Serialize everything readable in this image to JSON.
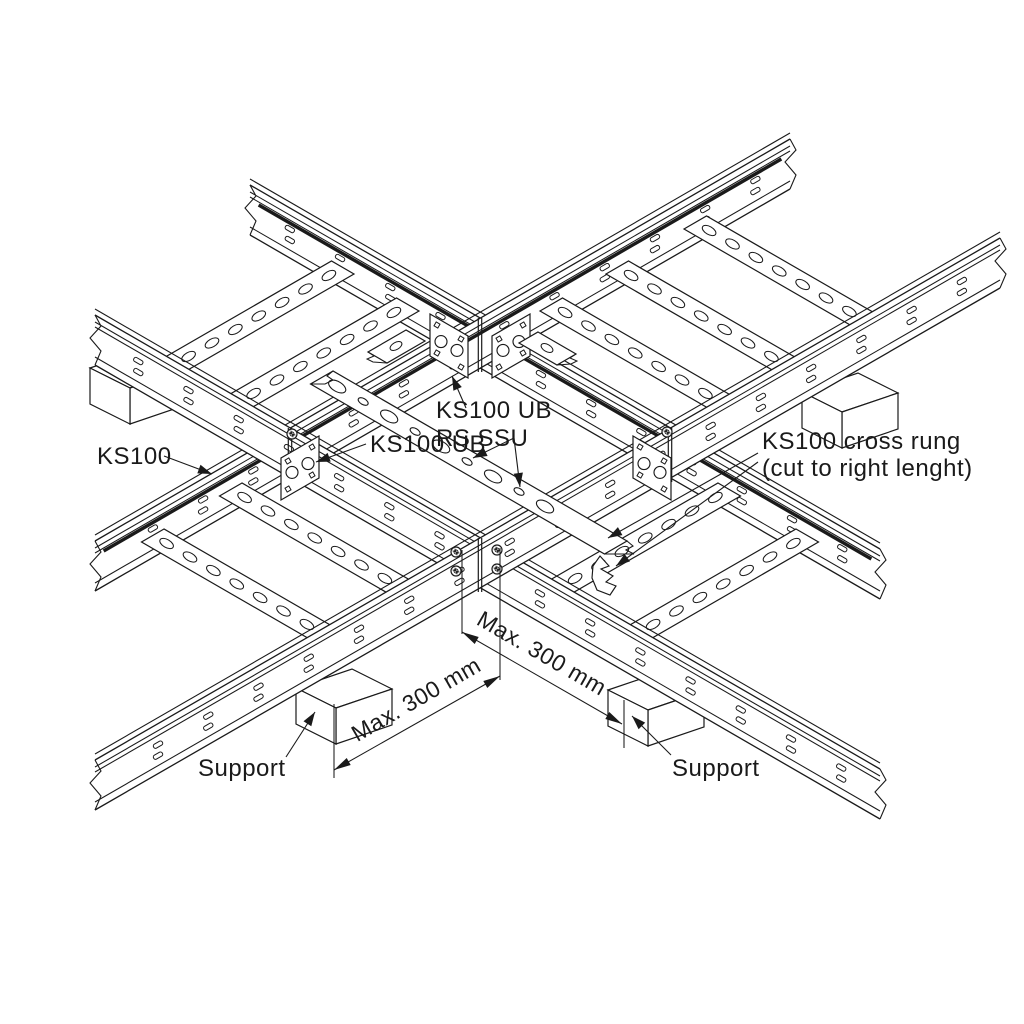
{
  "diagram": {
    "title": "KS100 cable ladder crossing installation detail",
    "labels": {
      "ks100_ub_top": "KS100 UB",
      "rs_ssu": "RS SSU",
      "cross_rung_1": "KS100 cross rung",
      "cross_rung_2": "(cut to right lenght)",
      "ks100": "KS100",
      "ks100_ub_left": "KS100 UB",
      "support_left": "Support",
      "support_right": "Support"
    },
    "dimensions": {
      "left": "Max. 300 mm",
      "right": "Max. 300 mm"
    },
    "colors": {
      "line": "#1a1a1a",
      "background": "#ffffff"
    }
  }
}
